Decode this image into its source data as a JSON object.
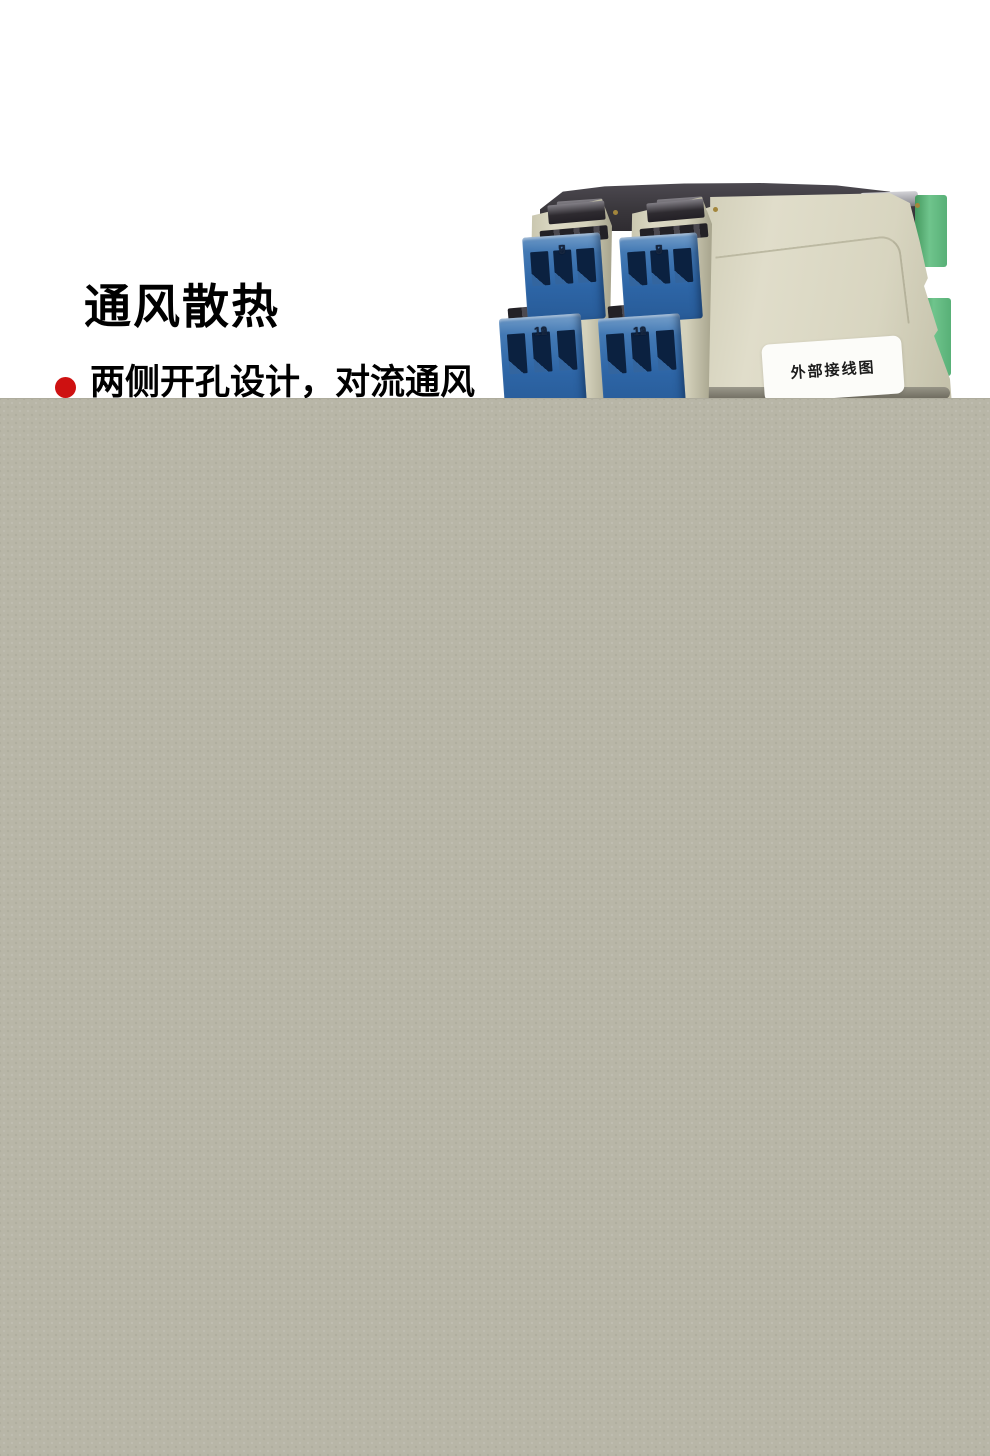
{
  "page": {
    "background_color": "#ffffff"
  },
  "content": {
    "heading": "通风散热",
    "bullets": [
      {
        "marker_color": "#ce1111",
        "text": "两侧开孔设计，对流通风"
      }
    ]
  },
  "product_photo": {
    "name": "din-rail-signal-isolator-modules",
    "module_count": 2,
    "wiring_label": "外部接线图",
    "terminal_rows": [
      {
        "numbers": [
          "7",
          "8",
          "9"
        ]
      },
      {
        "numbers": [
          "10",
          "11",
          "12"
        ]
      }
    ],
    "colors": {
      "body_cream": "#d8d5c0",
      "cap_dark": "#3a373c",
      "terminal_blue": "#2d65a6",
      "connector_green": "#5fba80",
      "label_white": "#fcfcf9"
    }
  },
  "overlay": {
    "color": "#b8b6a7"
  }
}
